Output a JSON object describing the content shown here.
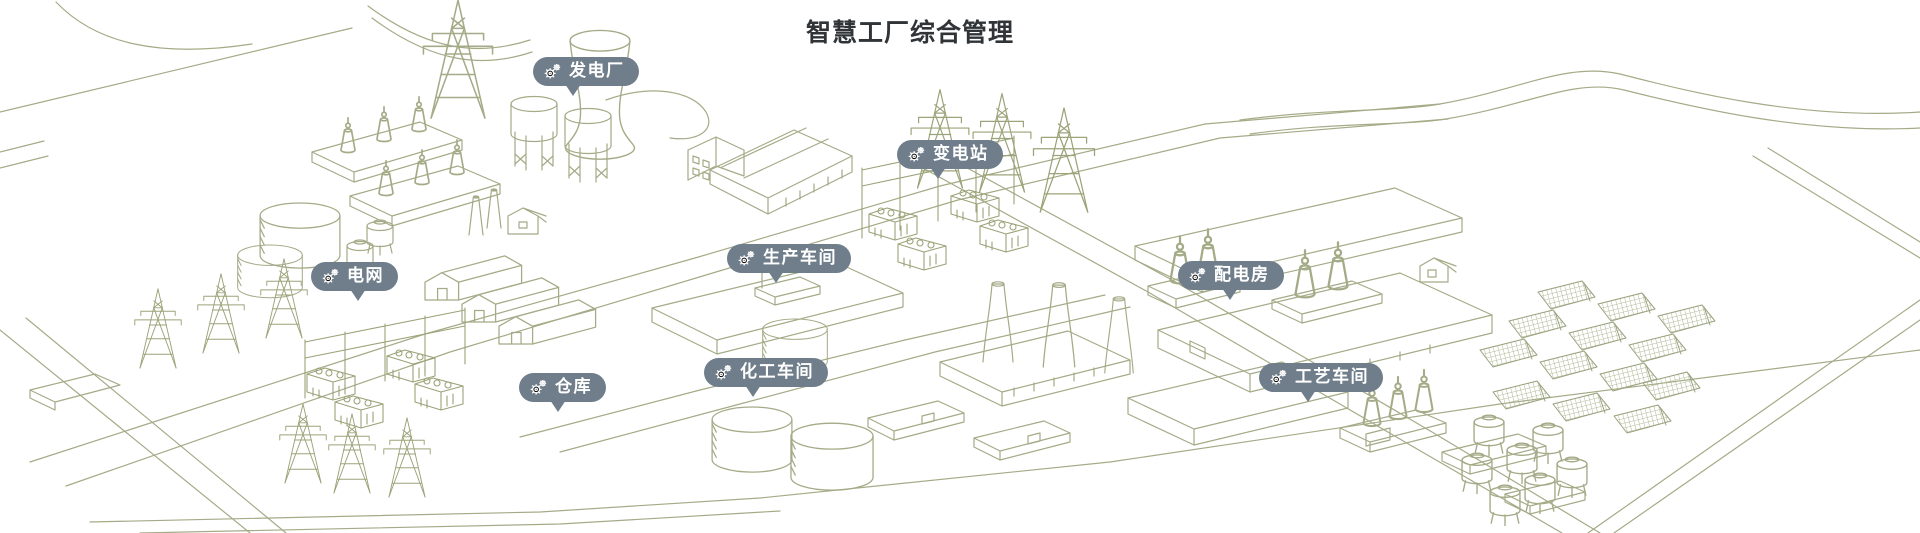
{
  "page": {
    "title": "智慧工厂综合管理"
  },
  "colors": {
    "background": "#ffffff",
    "line_art": "#a4ab87",
    "line_art_dense": "#9ba378",
    "pin_background": "#6f7e8a",
    "pin_text": "#ffffff",
    "title_text": "#303437"
  },
  "icons": {
    "pin_icon": "gears-icon"
  },
  "pins": [
    {
      "id": "power-plant",
      "label": "发电厂"
    },
    {
      "id": "substation",
      "label": "变电站"
    },
    {
      "id": "power-grid",
      "label": "电网"
    },
    {
      "id": "production-workshop",
      "label": "生产车间"
    },
    {
      "id": "distribution-room",
      "label": "配电房"
    },
    {
      "id": "warehouse",
      "label": "仓库"
    },
    {
      "id": "chemical-workshop",
      "label": "化工车间"
    },
    {
      "id": "process-workshop",
      "label": "工艺车间"
    }
  ],
  "illustration": {
    "style": "isometric line art",
    "areas": [
      "roads",
      "power-plant",
      "transmission-towers",
      "substation",
      "grid-yard",
      "storage-tanks",
      "warehouse-sheds",
      "production-building",
      "chemical-tanks",
      "chimneys",
      "distribution-building",
      "process-buildings",
      "solar-panel-field",
      "hoppers"
    ]
  }
}
